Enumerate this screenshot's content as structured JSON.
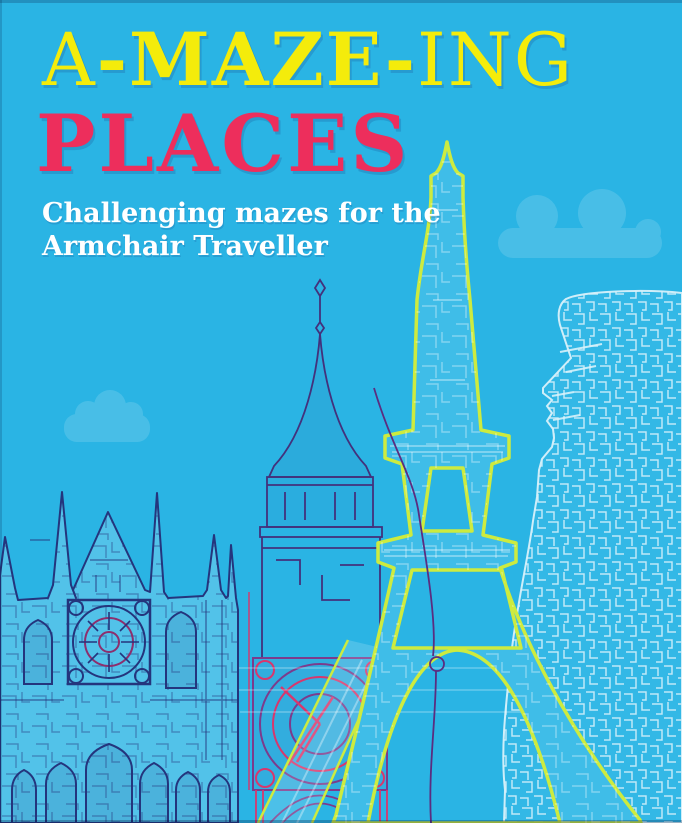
{
  "cover": {
    "title": {
      "part1": "A",
      "part2": "-MAZE-",
      "part3": "ING",
      "line2": "PLACES"
    },
    "subtitle": {
      "line1": "Challenging mazes for the",
      "line2": "Armchair Traveller"
    }
  },
  "colors": {
    "background": "#2ab4e4",
    "title_yellow": "#f4ec0b",
    "title_pink": "#ed2e5c",
    "subtitle_white": "#ffffff",
    "eiffel_tower_outline": "#cdeb3f",
    "big_ben_outline": "#43317c",
    "big_ben_clock_pink": "#d8376d",
    "cathedral_outline": "#24357d",
    "moai_maze_lines": "#d8f2fb",
    "cloud_tint": "#4cc0e9",
    "route_line_purple": "#5b2d80"
  },
  "artwork": {
    "landmarks": [
      {
        "id": "cathedral",
        "label": "gothic-cathedral-maze"
      },
      {
        "id": "big-ben",
        "label": "big-ben-clock-tower-maze"
      },
      {
        "id": "eiffel-tower",
        "label": "eiffel-tower-maze"
      },
      {
        "id": "moai-statue",
        "label": "easter-island-moai-maze"
      }
    ],
    "clouds": 2
  }
}
